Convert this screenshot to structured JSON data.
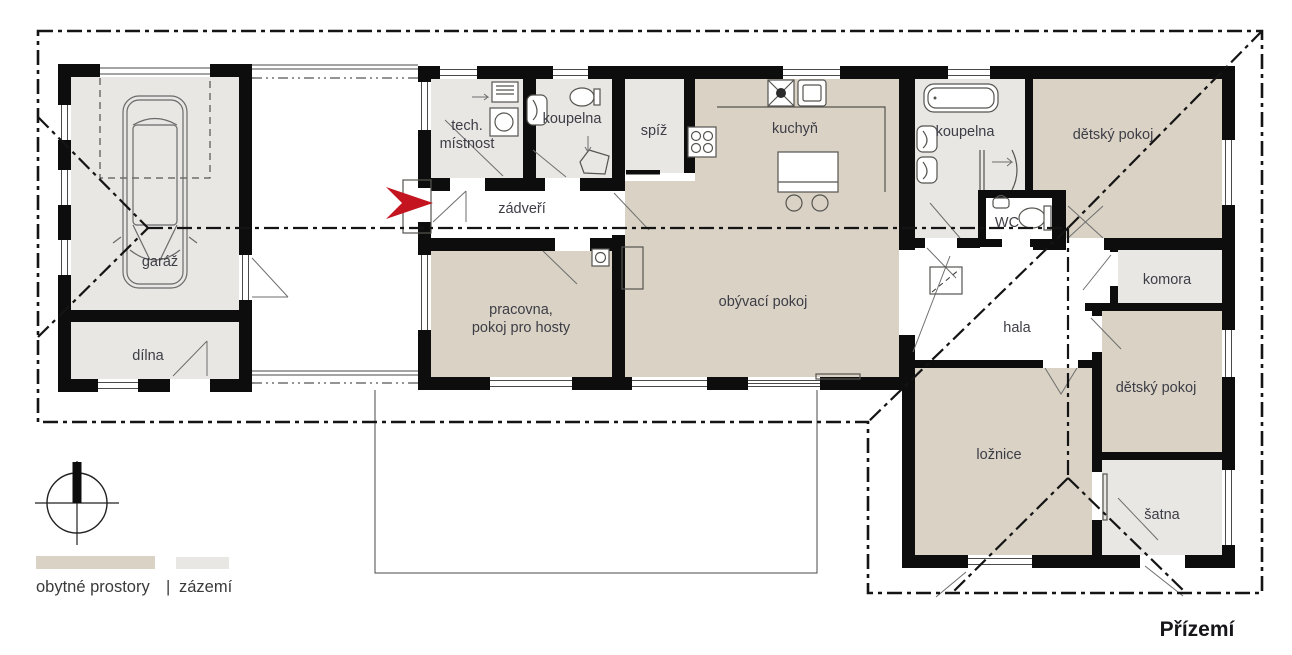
{
  "title": "Přízemí",
  "colors": {
    "living": "#d9d2c5",
    "utility": "#e8e7e4",
    "wall": "#0d0d0d",
    "accent_red": "#c41420",
    "label": "#3d3d46"
  },
  "legend": {
    "living": "obytné prostory",
    "separator": "|",
    "utility": "zázemí"
  },
  "rooms": {
    "garaz": {
      "label": "garáž"
    },
    "dilna": {
      "label": "dílna"
    },
    "tech_mistnost": {
      "label_line1": "tech.",
      "label_line2": "místnost"
    },
    "koupelna_small": {
      "label": "koupelna"
    },
    "zadveri": {
      "label": "zádveří"
    },
    "pracovna": {
      "label_line1": "pracovna,",
      "label_line2": "pokoj pro hosty"
    },
    "spiz": {
      "label": "spíž"
    },
    "kuchyn": {
      "label": "kuchyň"
    },
    "obyvaci_pokoj": {
      "label": "obývací pokoj"
    },
    "koupelna_big": {
      "label": "koupelna"
    },
    "wc": {
      "label": "WC"
    },
    "detsky_pokoj_1": {
      "label": "dětský pokoj"
    },
    "komora": {
      "label": "komora"
    },
    "hala": {
      "label": "hala"
    },
    "detsky_pokoj_2": {
      "label": "dětský pokoj"
    },
    "loznice": {
      "label": "ložnice"
    },
    "satna": {
      "label": "šatna"
    }
  }
}
